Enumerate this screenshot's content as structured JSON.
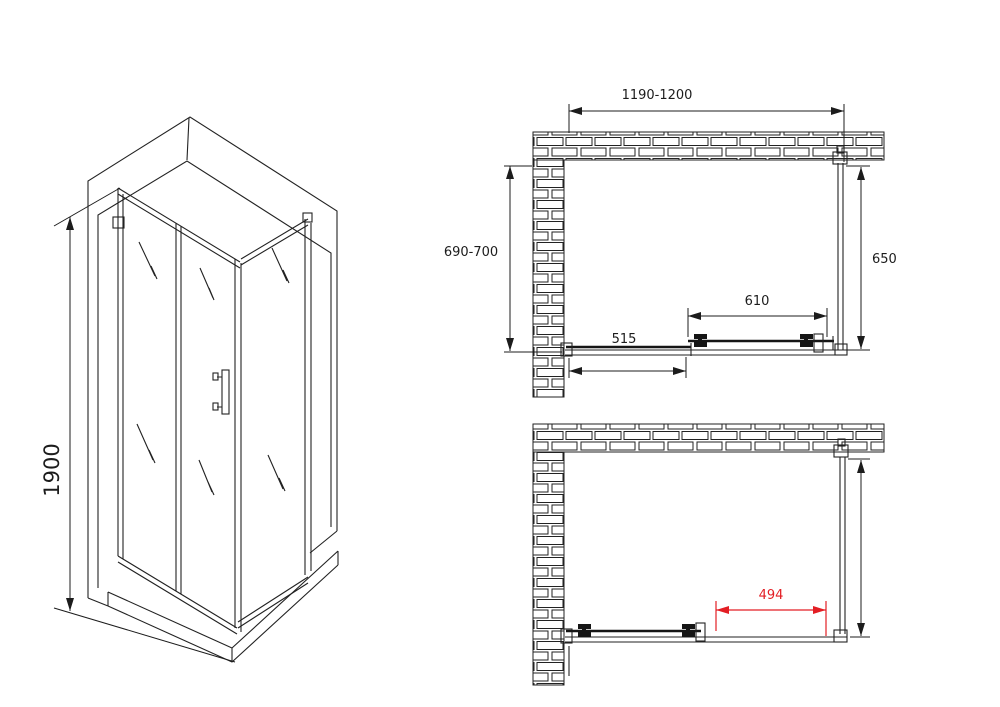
{
  "title": "Shower enclosure technical drawing",
  "colors": {
    "line": "#222222",
    "dimension_red": "#e31e24",
    "background": "#ffffff"
  },
  "iso_view": {
    "height_dimension": "1900"
  },
  "plan_top": {
    "width_dimension": "1190-1200",
    "depth_dimension": "690-700",
    "side_panel_dimension": "650",
    "door_dimension": "610",
    "fixed_panel_dimension": "515"
  },
  "plan_bottom": {
    "opening_dimension": "494"
  }
}
